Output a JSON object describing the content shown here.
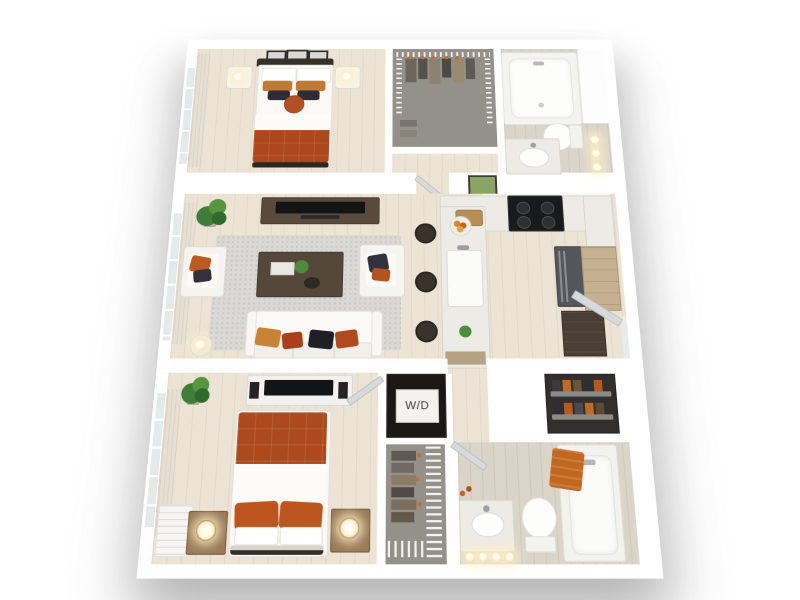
{
  "scene": {
    "type": "3d-floorplan-render",
    "description": "Top-down 3D rendering of a two-bedroom, two-bathroom apartment floor plan on a white background",
    "background_color": "#ffffff"
  },
  "labels": {
    "washer_dryer": "W/D"
  },
  "palette": {
    "wall_white": "#ffffff",
    "wood_floor": "#ece3d5",
    "bath_floor": "#dbd4c9",
    "closet_floor": "#94908a",
    "rug_gray": "#dad8d4",
    "accent_rust_duvet": "#ad481c",
    "accent_orange_pillow": "#bf5a1f",
    "accent_tan_pillow": "#c98236",
    "dark_navy_pillow": "#2e2d37",
    "dark_wood": "#55473a",
    "cabinet_wood": "#c5b091",
    "appliance_black": "#191a1b",
    "stainless_gray": "#53565a",
    "plant_green": "#4d8c3a",
    "lamp_glow": "#ffeebb"
  },
  "rooms": [
    {
      "name": "bedroom-1",
      "position": "top-left",
      "furniture": [
        "queen-bed-rust-duvet",
        "headboard",
        "nightstand-left",
        "nightstand-right",
        "table-lamp-left",
        "table-lamp-right",
        "wall-art-frames",
        "window-with-curtain"
      ]
    },
    {
      "name": "walk-in-closet-1",
      "position": "top-middle",
      "furniture": [
        "wire-shelving",
        "hanging-clothes"
      ]
    },
    {
      "name": "hallway-1",
      "position": "below-closet-1",
      "furniture": [
        "door"
      ]
    },
    {
      "name": "bathroom-1",
      "position": "top-right",
      "furniture": [
        "bathtub",
        "toilet",
        "vanity-with-sink",
        "vanity-lights"
      ]
    },
    {
      "name": "living-room",
      "position": "middle-left",
      "furniture": [
        "tv-console",
        "tv",
        "area-rug",
        "coffee-table",
        "sofa-with-pillows",
        "armchair-left",
        "armchair-right",
        "side-table-lamp",
        "potted-plant",
        "window-with-curtain"
      ]
    },
    {
      "name": "kitchen",
      "position": "middle-right",
      "furniture": [
        "island-with-sink",
        "bar-stools-x3",
        "counter",
        "range-cooktop",
        "refrigerator",
        "pantry-cabinet",
        "dark-console",
        "cutting-board",
        "fruit-bowl",
        "wall-art"
      ]
    },
    {
      "name": "entry",
      "position": "right-wall",
      "furniture": [
        "entry-door"
      ]
    },
    {
      "name": "laundry-closet",
      "position": "center-bottom",
      "furniture": [
        "stacked-washer-dryer"
      ],
      "label": "W/D"
    },
    {
      "name": "bedroom-2",
      "position": "bottom-left",
      "furniture": [
        "queen-bed-rust-duvet",
        "dresser-with-tv",
        "nightstand-left",
        "nightstand-right",
        "table-lamp-left",
        "table-lamp-right",
        "potted-plant",
        "window-with-curtain",
        "louvered-shutters"
      ]
    },
    {
      "name": "walk-in-closet-2",
      "position": "bottom-middle",
      "furniture": [
        "wire-shelving",
        "hanging-clothes"
      ]
    },
    {
      "name": "linen-closet",
      "position": "bottom-right-upper",
      "furniture": [
        "wire-shelves",
        "shoes-and-linens"
      ]
    },
    {
      "name": "bathroom-2",
      "position": "bottom-right",
      "furniture": [
        "bathtub-with-towel",
        "toilet",
        "vanity-with-sink",
        "vanity-lights",
        "door"
      ]
    }
  ]
}
